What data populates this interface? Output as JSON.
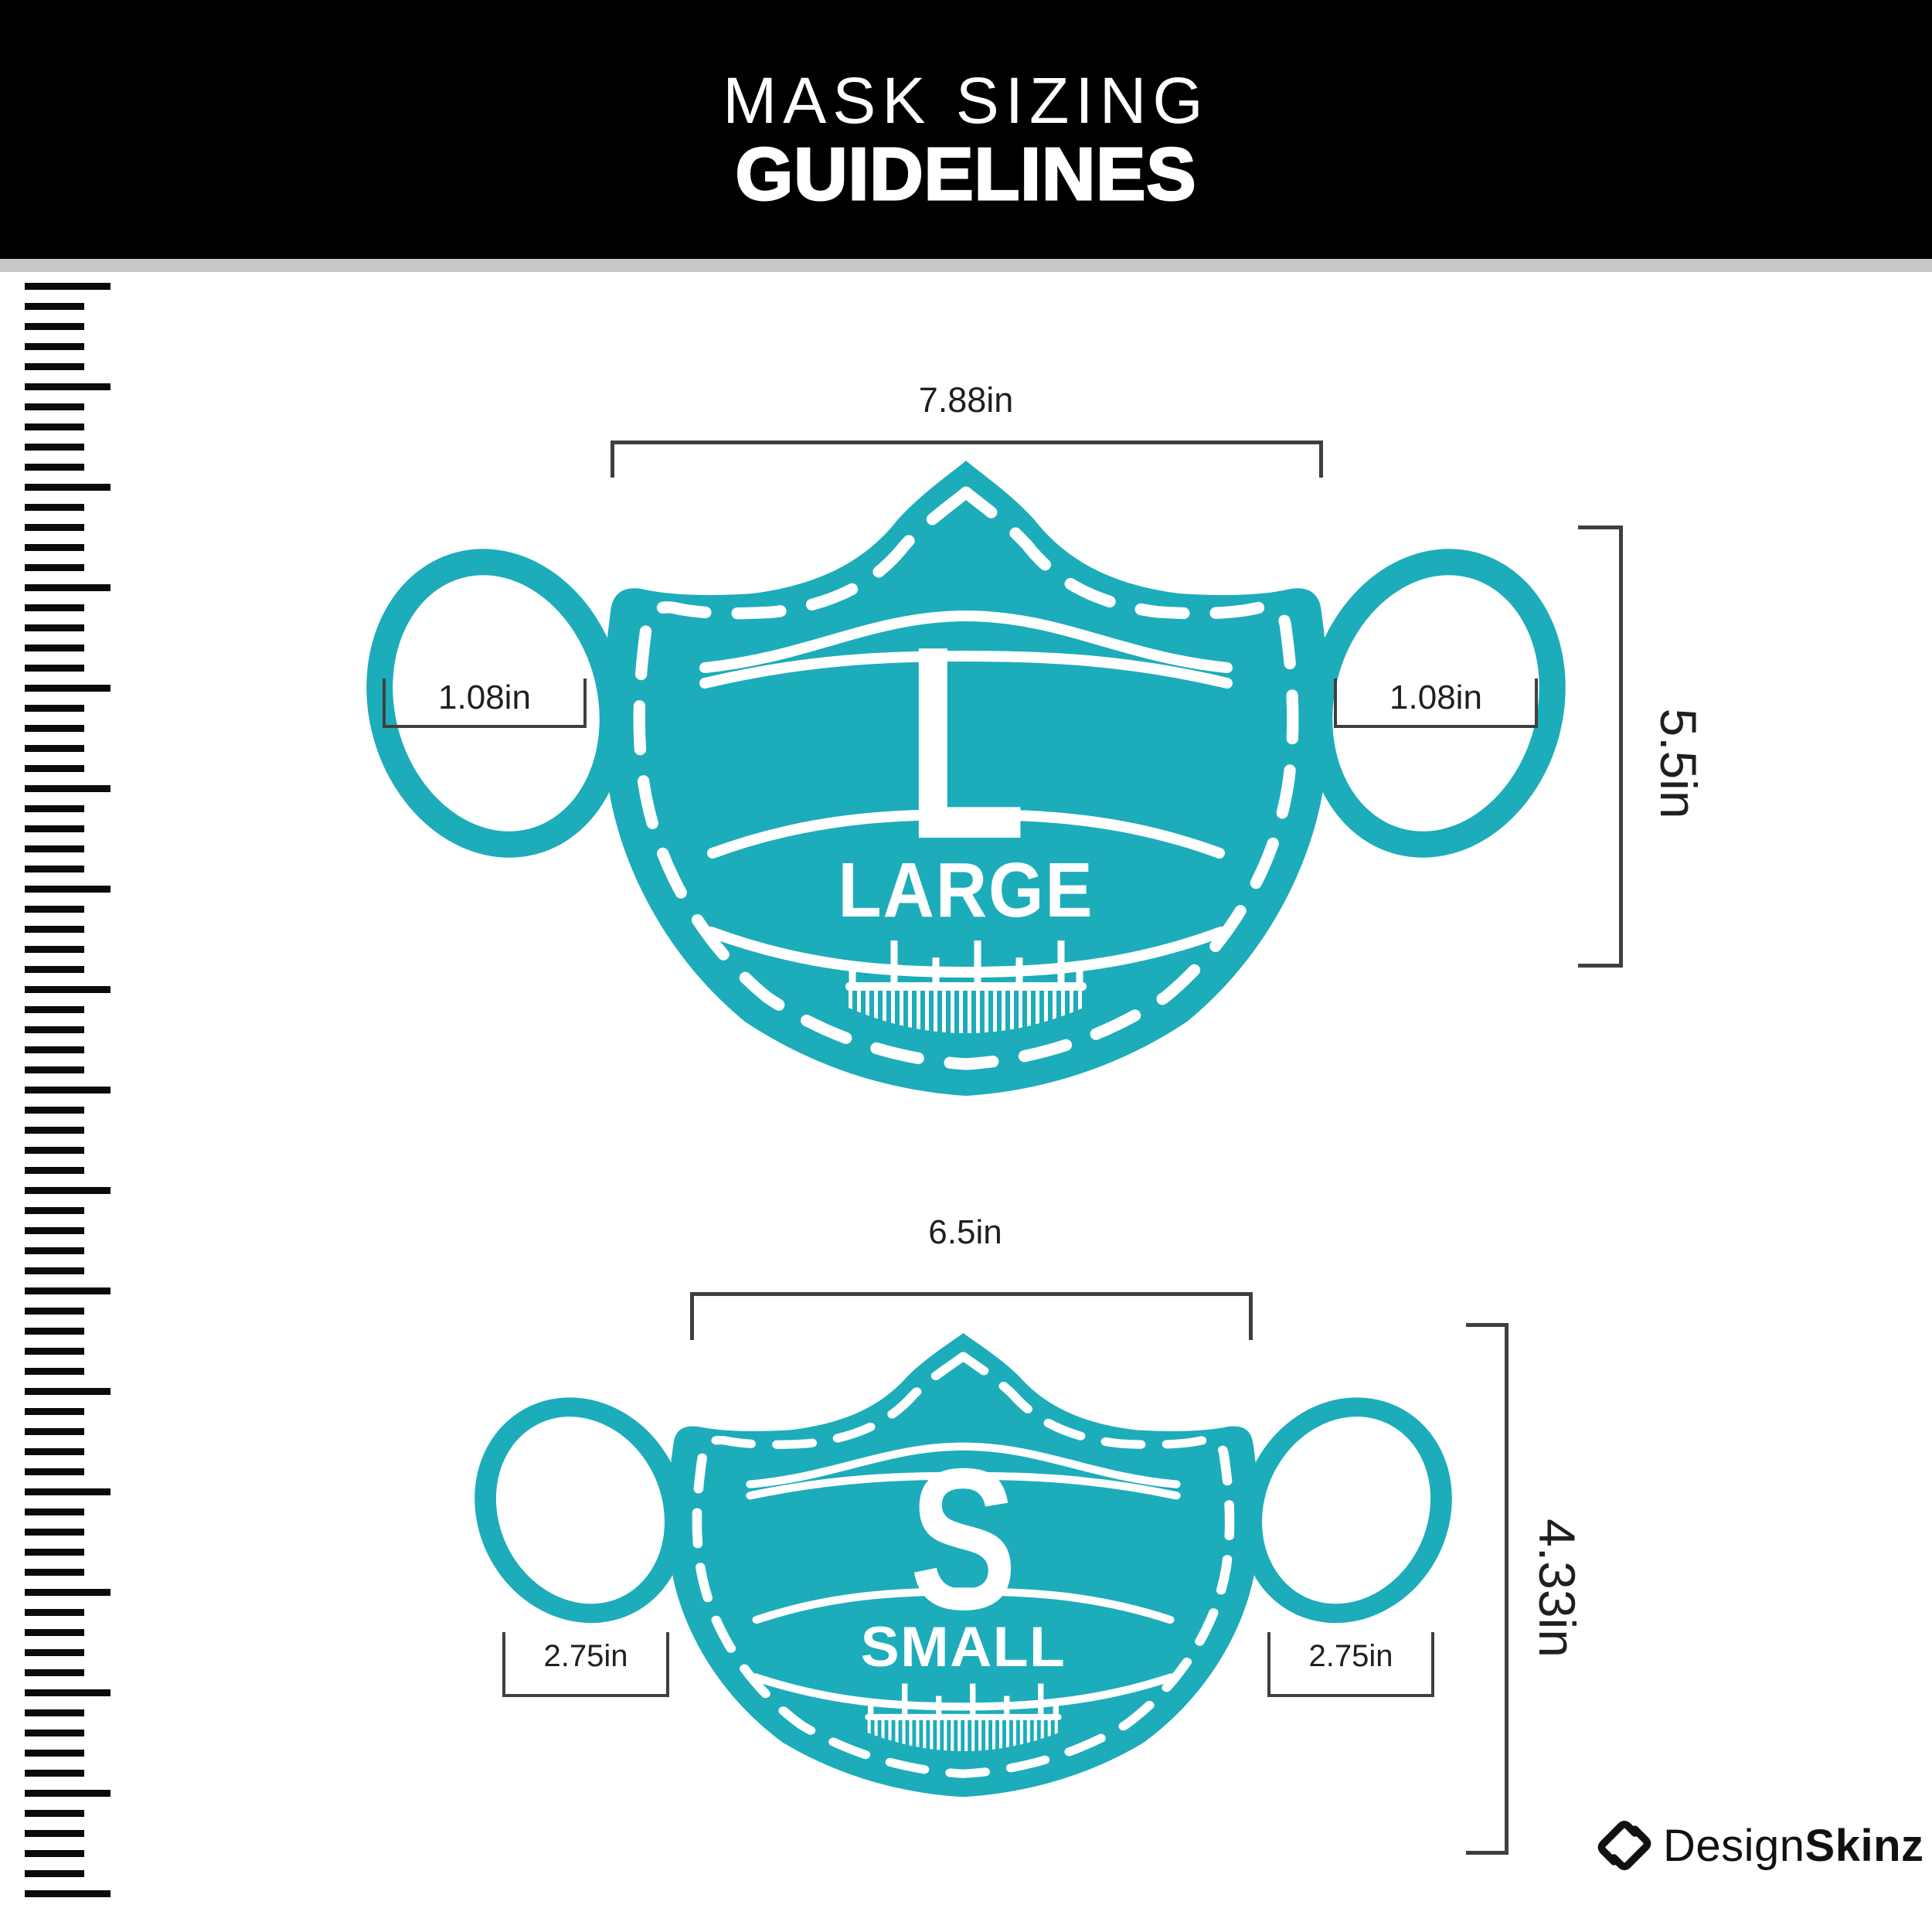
{
  "title": {
    "line1": "MASK SIZING",
    "line2": "GUIDELINES"
  },
  "colors": {
    "header-bg": "#000000",
    "header-text": "#ffffff",
    "divider": "#c8c8c8",
    "teal": "#1dacba",
    "dim-line": "#3f3f3f",
    "dim-text": "#1f1f1f",
    "ruler": "#0b0b0b",
    "brand": "#111111"
  },
  "masks": {
    "large": {
      "letter": "L",
      "name": "LARGE",
      "width": "7.88in",
      "height": "5.5in",
      "ear_left": "1.08in",
      "ear_right": "1.08in"
    },
    "small": {
      "letter": "S",
      "name": "SMALL",
      "width": "6.5in",
      "height": "4.33in",
      "ear_left": "2.75in",
      "ear_right": "2.75in"
    }
  },
  "brand": {
    "regular": "Design",
    "bold": "Skinz"
  }
}
